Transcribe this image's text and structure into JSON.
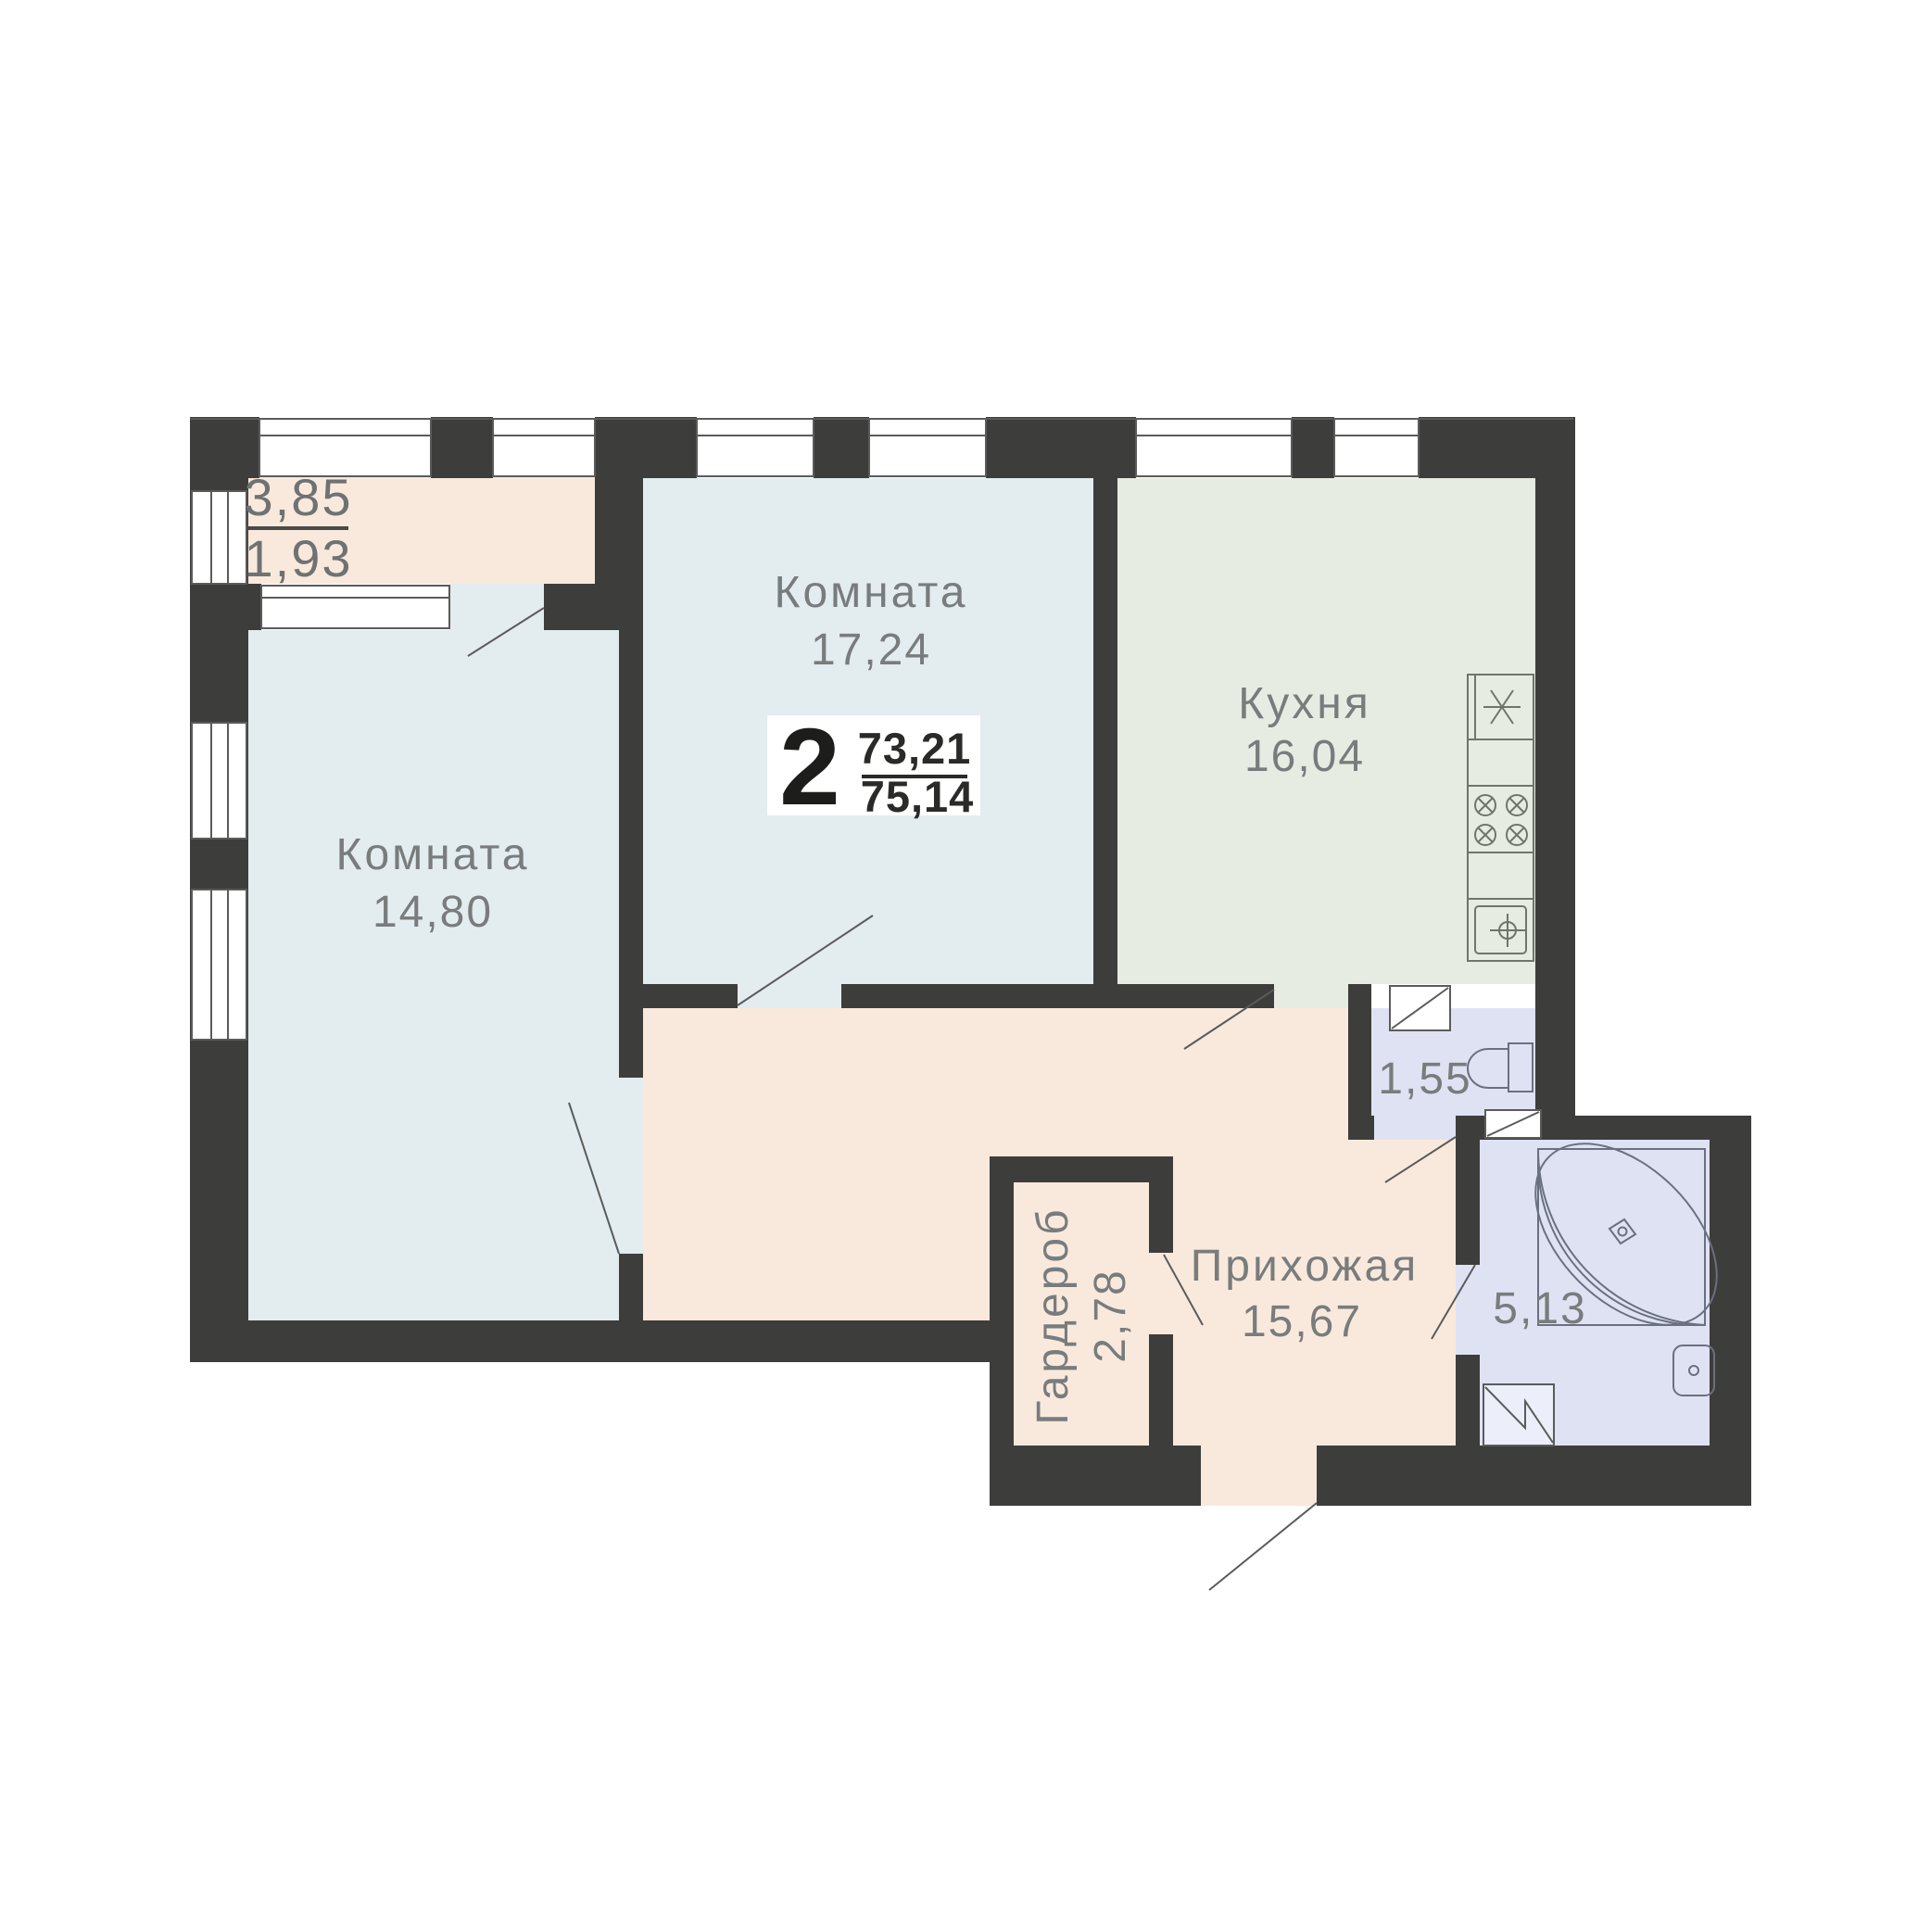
{
  "plan": {
    "title": "2-room apartment floor plan",
    "summary": {
      "rooms_count": "2",
      "area_upper": "73,21",
      "area_lower": "75,14"
    },
    "rooms": {
      "room_top": {
        "name": "Комната",
        "area": "17,24"
      },
      "room_left": {
        "name": "Комната",
        "area": "14,80"
      },
      "kitchen": {
        "name": "Кухня",
        "area": "16,04"
      },
      "hallway": {
        "name": "Прихожая",
        "area": "15,67"
      },
      "wardrobe": {
        "name": "Гардероб",
        "area": "2,78"
      },
      "wc": {
        "area": "1,55"
      },
      "bathroom": {
        "area": "5,13"
      },
      "balcony": {
        "area_full": "3,85",
        "area_reduced": "1,93"
      }
    },
    "icons": {
      "fridge": "fridge-icon (asterisk symbol)",
      "stove": "stove-burners-icon (4 crossed circles)",
      "kitchen_sink": "kitchen-sink-icon (crosshair in square)",
      "toilet": "toilet-icon",
      "bathtub": "corner-bathtub-icon",
      "bath_sink": "washbasin-icon",
      "vent": "ventilation-shaft-icon (box with diagonal)",
      "door": "door-swing-line",
      "window": "window-glazing"
    },
    "colors": {
      "wall": "#3d3d3b",
      "room_blue": "#e3ecee",
      "kitchen_green": "#e7ece2",
      "hall_peach": "#f9e9dc",
      "wet_lavender": "#dfe2f3",
      "white": "#ffffff",
      "line": "#5b5b5b",
      "label": "#797c7d",
      "dark_text": "#1d1d1b"
    }
  }
}
